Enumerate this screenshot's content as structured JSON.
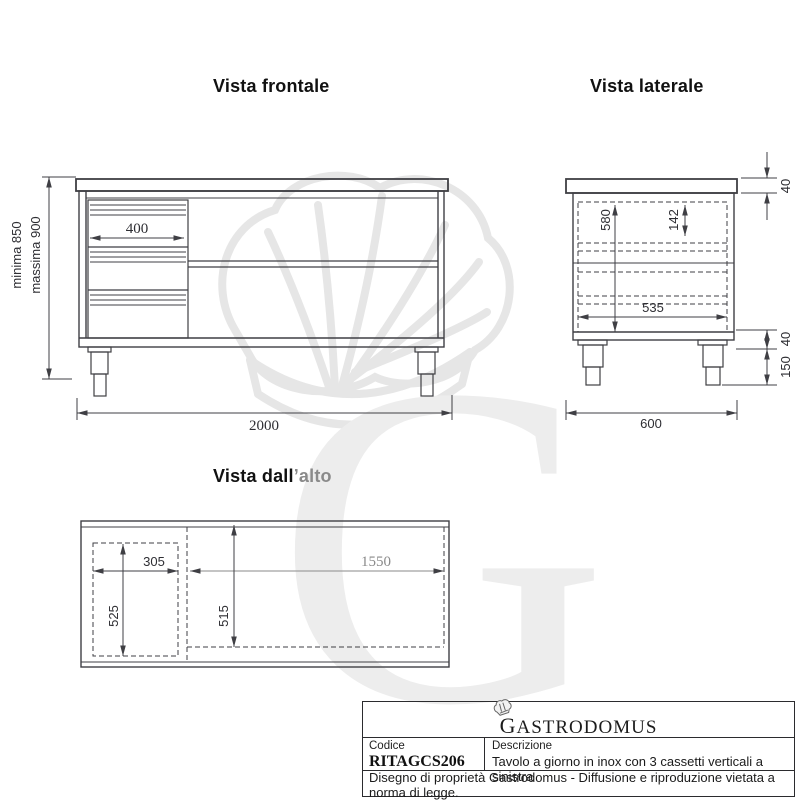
{
  "views": {
    "frontal": {
      "title": "Vista frontale",
      "dims": {
        "drawer_width": "400",
        "total_width": "2000",
        "height_min": "minima 850",
        "height_max": "massima 900"
      }
    },
    "lateral": {
      "title": "Vista laterale",
      "dims": {
        "top_thickness": "40",
        "inner_height": "580",
        "drawer_inner_height": "142",
        "inner_depth": "535",
        "base_band": "40",
        "leg_height": "150",
        "total_depth": "600"
      }
    },
    "top": {
      "title_black": "Vista dall",
      "title_gray": "’alto",
      "dims": {
        "drawer_block_width": "305",
        "open_width": "1550",
        "drawer_block_depth": "525",
        "inner_depth": "515"
      }
    }
  },
  "title_block": {
    "brand": "Gastrodomus",
    "code_label": "Codice",
    "code_value": "RITAGCS206",
    "description_label": "Descrizione",
    "description_value": "Tavolo a giorno in inox con 3 cassetti verticali a sinistra",
    "footer": "Disegno di proprietà Gastrodomus -  Diffusione e riproduzione vietata a norma di legge."
  },
  "colors": {
    "line": "#3f3f44",
    "dim_text": "#2e2e33",
    "gray_text": "#8a8a8a",
    "watermark": "#e6e6e6"
  }
}
